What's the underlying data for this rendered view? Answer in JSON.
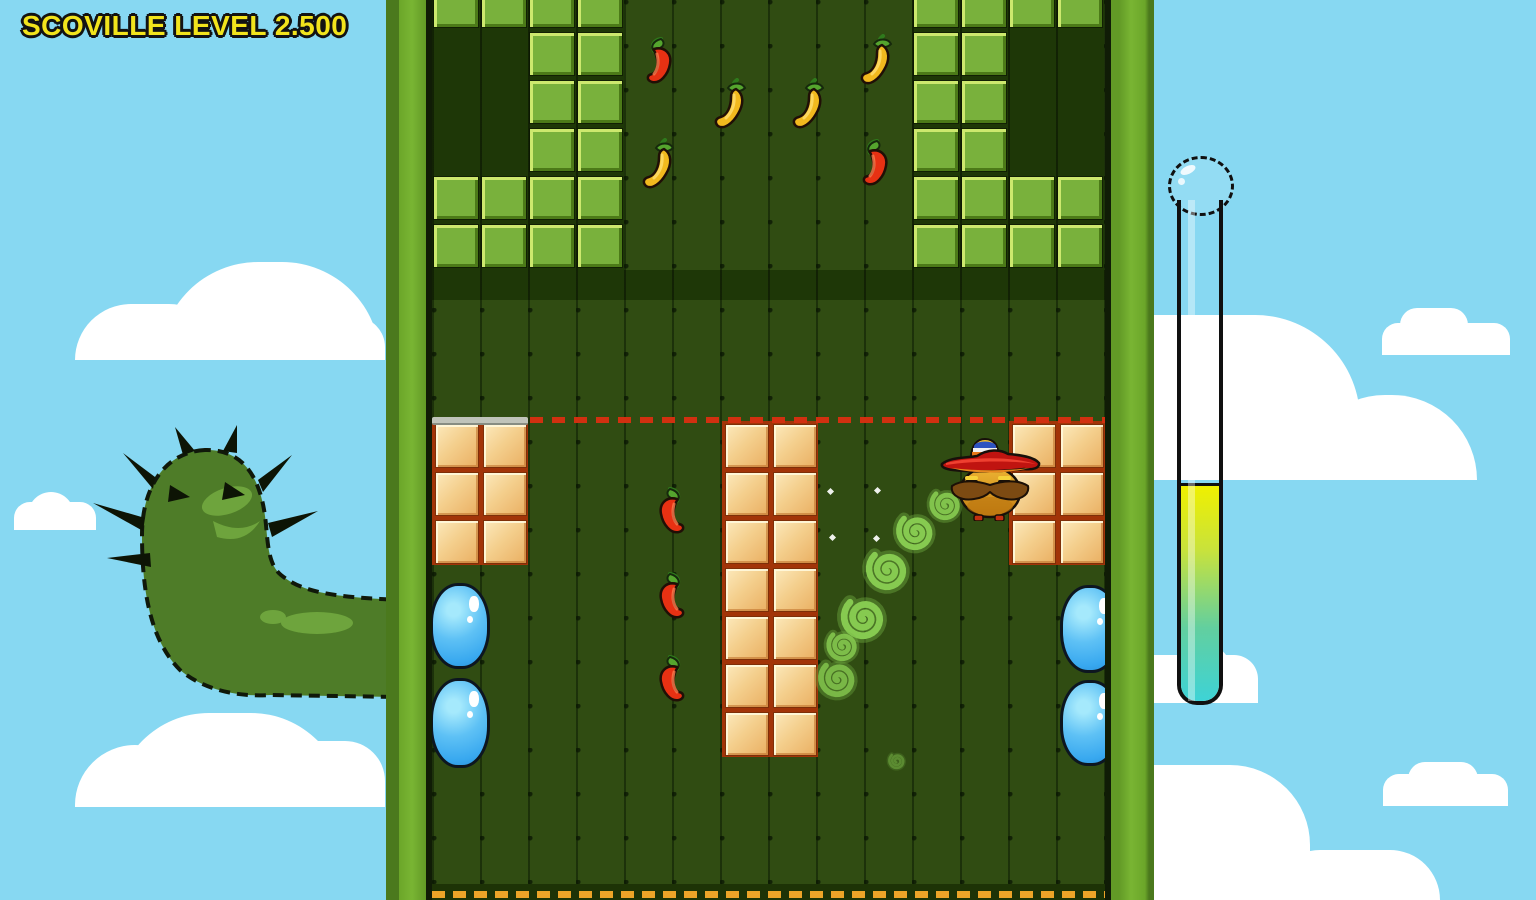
{
  "hud": {
    "scoville_label": "SCOVILLE LEVEL",
    "scoville_value": "2.500"
  },
  "thermometer": {
    "fill_ratio": 0.43
  },
  "colors": {
    "sky": "#87d8f2",
    "field": "#304c12",
    "field_dark": "#1e3707",
    "frame_bright": "#79b533",
    "frame_dark": "#4b791d",
    "green_brick": "#79b13c",
    "tan_brick": "#f4cf8d",
    "mortar": "#a23408",
    "dash_red": "#d13010",
    "dash_orange": "#eda428",
    "trail_green": "#86ca50",
    "droplet_blue": "#5ec1f5",
    "cloud": "#ffffff"
  },
  "playfield": {
    "brick_size": 48,
    "green_bricks": [
      {
        "x": 0,
        "y": -17
      },
      {
        "x": 48,
        "y": -17
      },
      {
        "x": 96,
        "y": -17
      },
      {
        "x": 144,
        "y": -17
      },
      {
        "x": 480,
        "y": -17
      },
      {
        "x": 528,
        "y": -17
      },
      {
        "x": 576,
        "y": -17
      },
      {
        "x": 624,
        "y": -17
      },
      {
        "x": 96,
        "y": 31
      },
      {
        "x": 144,
        "y": 31
      },
      {
        "x": 480,
        "y": 31
      },
      {
        "x": 528,
        "y": 31
      },
      {
        "x": 96,
        "y": 79
      },
      {
        "x": 144,
        "y": 79
      },
      {
        "x": 480,
        "y": 79
      },
      {
        "x": 528,
        "y": 79
      },
      {
        "x": 96,
        "y": 127
      },
      {
        "x": 144,
        "y": 127
      },
      {
        "x": 480,
        "y": 127
      },
      {
        "x": 528,
        "y": 127
      },
      {
        "x": 0,
        "y": 175
      },
      {
        "x": 48,
        "y": 175
      },
      {
        "x": 96,
        "y": 175
      },
      {
        "x": 144,
        "y": 175
      },
      {
        "x": 480,
        "y": 175
      },
      {
        "x": 528,
        "y": 175
      },
      {
        "x": 576,
        "y": 175
      },
      {
        "x": 624,
        "y": 175
      },
      {
        "x": 0,
        "y": 223
      },
      {
        "x": 48,
        "y": 223
      },
      {
        "x": 96,
        "y": 223
      },
      {
        "x": 144,
        "y": 223
      },
      {
        "x": 480,
        "y": 223
      },
      {
        "x": 528,
        "y": 223
      },
      {
        "x": 576,
        "y": 223
      },
      {
        "x": 624,
        "y": 223
      }
    ],
    "tan_blocks": [
      {
        "x": 0,
        "y": 421,
        "cols": 2,
        "rows": 3
      },
      {
        "x": 290,
        "y": 421,
        "cols": 2,
        "rows": 7
      },
      {
        "x": 577,
        "y": 421,
        "cols": 2,
        "rows": 3
      }
    ],
    "steel_bar": {
      "x": 0,
      "y": 417,
      "w": 96
    },
    "dotted_line": {
      "x": 98,
      "y": 417,
      "w": 575
    },
    "bottom_band": {
      "x": 0,
      "y": 884,
      "w": 673,
      "h": 16
    },
    "bottom_line": {
      "x": 0,
      "y": 891,
      "w": 673
    },
    "peppers": [
      {
        "type": "red",
        "x": 208,
        "y": 36,
        "flip": false
      },
      {
        "type": "yellow",
        "x": 278,
        "y": 78,
        "flip": false
      },
      {
        "type": "yellow",
        "x": 356,
        "y": 78,
        "flip": false
      },
      {
        "type": "yellow",
        "x": 424,
        "y": 34,
        "flip": false
      },
      {
        "type": "yellow",
        "x": 206,
        "y": 138,
        "flip": false
      },
      {
        "type": "red",
        "x": 424,
        "y": 138,
        "flip": false
      },
      {
        "type": "red",
        "x": 221,
        "y": 486,
        "flip": true
      },
      {
        "type": "red",
        "x": 221,
        "y": 571,
        "flip": true
      },
      {
        "type": "red",
        "x": 221,
        "y": 654,
        "flip": true
      }
    ],
    "droplets": [
      {
        "x": -2,
        "y": 583,
        "w": 54,
        "h": 80
      },
      {
        "x": -2,
        "y": 678,
        "w": 54,
        "h": 84
      },
      {
        "x": 628,
        "y": 585,
        "w": 54,
        "h": 82
      },
      {
        "x": 628,
        "y": 680,
        "w": 54,
        "h": 80
      }
    ],
    "spirals": [
      {
        "x": 514,
        "y": 505,
        "d": 30,
        "o": 0.95
      },
      {
        "x": 484,
        "y": 532,
        "d": 36,
        "o": 1
      },
      {
        "x": 456,
        "y": 570,
        "d": 40,
        "o": 1
      },
      {
        "x": 432,
        "y": 618,
        "d": 42,
        "o": 1
      },
      {
        "x": 411,
        "y": 646,
        "d": 30,
        "o": 0.9
      },
      {
        "x": 406,
        "y": 679,
        "d": 36,
        "o": 0.85
      },
      {
        "x": 465,
        "y": 761,
        "d": 16,
        "o": 0.5
      }
    ],
    "sparkles": [
      {
        "x": 396,
        "y": 489
      },
      {
        "x": 443,
        "y": 488
      },
      {
        "x": 398,
        "y": 535
      },
      {
        "x": 442,
        "y": 536
      }
    ],
    "character": {
      "x": 506,
      "y": 436
    }
  }
}
